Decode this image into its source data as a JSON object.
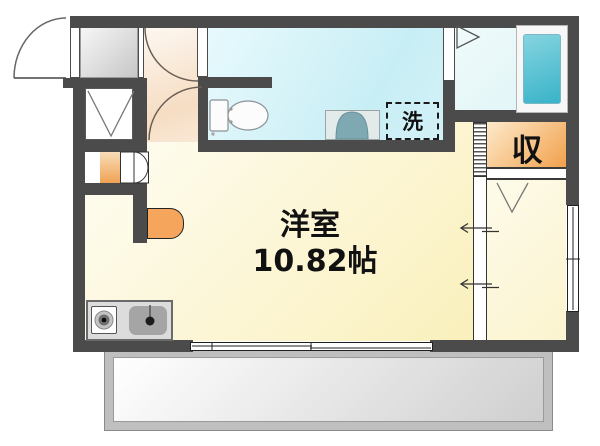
{
  "floorplan": {
    "rooms": {
      "main": {
        "name": "洋室",
        "area": "10.82帖"
      },
      "storage": {
        "label": "収"
      },
      "laundry": {
        "label": "洗"
      }
    },
    "fixtures": [
      "entrance-door",
      "shoe-cabinet",
      "bifold-closet-door",
      "toilet",
      "washbasin",
      "washing-machine-space",
      "bathtub",
      "bathroom-door",
      "stove-burner",
      "kitchen-sink",
      "counter-shelf",
      "sliding-partition",
      "sliding-window",
      "side-window",
      "balcony"
    ],
    "palette": {
      "wall": "#4b4b4b",
      "main_room_fill": "#faf0bc",
      "washroom_fill": "#c8eef5",
      "bathroom_fill": "#ddf3f6",
      "bathtub_fill": "#39b3c9",
      "storage_fill": "#f2a452",
      "closet_fill": "#efa254",
      "counter_fill": "#f6a55c",
      "genkan_fill": "#c7c7c7",
      "balcony_fill": "#bfbfbf"
    }
  }
}
